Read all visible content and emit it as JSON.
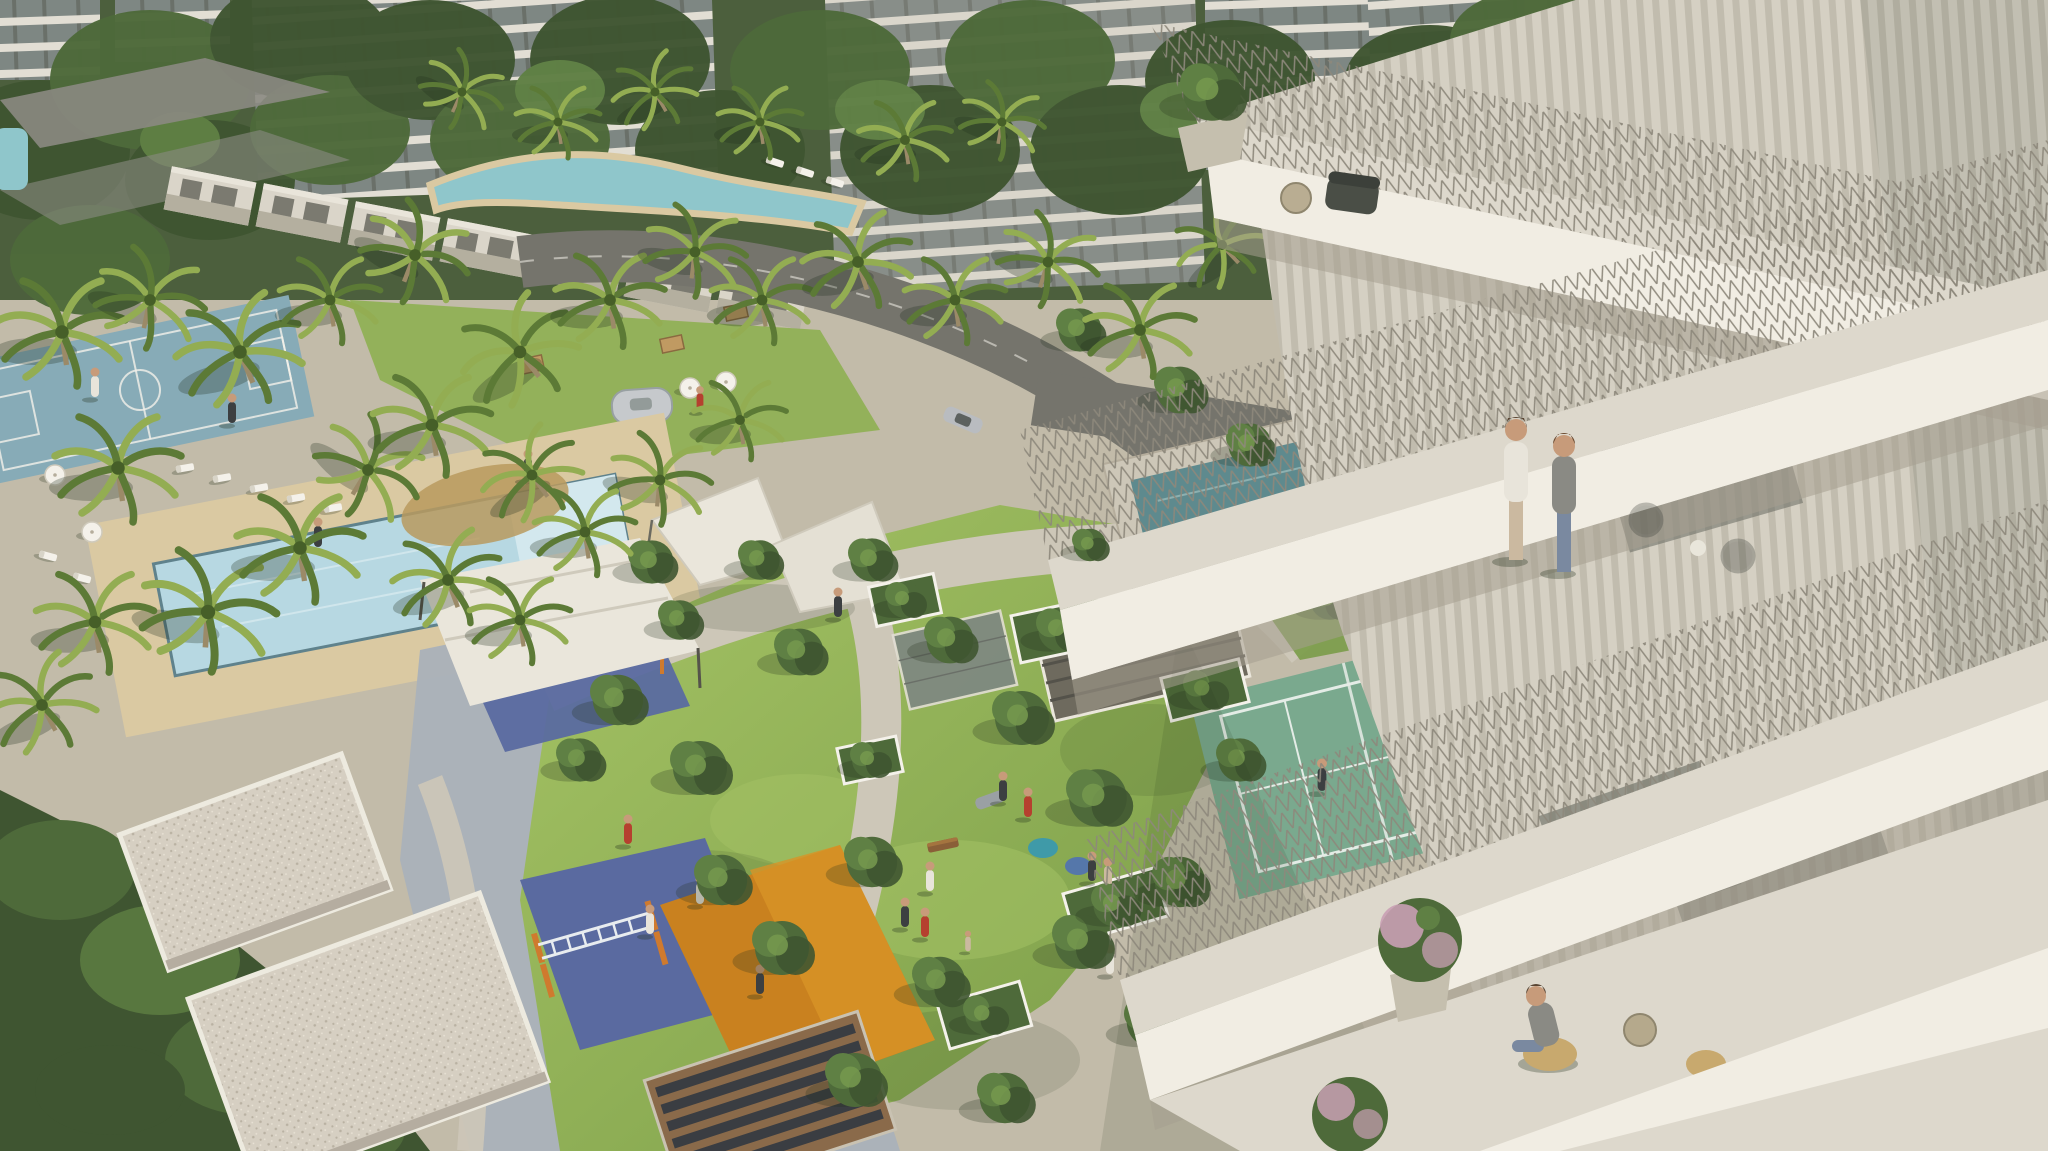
{
  "scene": {
    "type": "aerial-architectural-rendering",
    "elements": [
      "foreground-residential-tower-with-balconies",
      "background-apartment-blocks",
      "townhouse-row",
      "palm-grove",
      "lagoon-pool",
      "lap-swimming-pool",
      "basketball-court",
      "tennis-court",
      "reflecting-pool",
      "central-lawn",
      "shade-sails",
      "fitness-playground",
      "calisthenics-canopy",
      "food-truck-plaza",
      "villa-rooftops",
      "roads-with-cars",
      "balcony-people",
      "park-people"
    ]
  },
  "palette": {
    "ground": "#c2bba9",
    "canopyDark": "#3f5531",
    "canopyMid": "#4e6a3a",
    "canopyLight": "#5f8044",
    "treeHighlight": "#74974e",
    "palmDark": "#5c7a36",
    "palmLight": "#93ad52",
    "trunk": "#9b8a68",
    "lawn": "#8fb054",
    "lawnLight": "#a6c465",
    "lawnShade": "#7a9c48",
    "dryGrass": "#b89a5e",
    "poolWater": "#b7d8e2",
    "poolStep": "#d3e8ee",
    "poolRim": "#5f828c",
    "lagoon": "#8fc6cb",
    "bballCourt": "#87abb7",
    "tennisCourt": "#7aa98e",
    "tennisLine": "#e4ece6",
    "canalWater": "#6fa6a0",
    "enclosureWater": "#5e8a8e",
    "sandDeck": "#dac9a2",
    "pathLight": "#cdc7b8",
    "plazaPavers": "#aab1b9",
    "asphalt": "#75746c",
    "asphaltLight": "#8b8a82",
    "roadMark": "#e8e6dd",
    "buildingWall": "#b8b2a4",
    "buildingBand": "#e2ded4",
    "glass": "#7e8783",
    "glassDark": "#5d6058",
    "villaWall": "#dad5c9",
    "villaShade": "#b4af9f",
    "villaGlass": "#6a6a60",
    "facade": "#d5d0c3",
    "facadeRib": "#c1bcae",
    "facadeShadow": "#a59f90",
    "slabWhite": "#f1ede3",
    "balconyFloor": "#ddd8cc",
    "railing": "#8d887b",
    "gravel": "#d6cfc2",
    "gravelDot": "#b9b1a2",
    "slatRoof": "#6e6a5e",
    "slatLine": "#54524a",
    "pergolaWood": "#8a6a4a",
    "pergolaGap": "#3a3d42",
    "canvasWhite": "#eae6db",
    "canvasShade": "#cfcabc",
    "playBlue": "#5a6aa0",
    "playOrange": "#c9811f",
    "playOrangeSun": "#d89427",
    "equipOrange": "#cf7a2e",
    "equipYellow": "#e2c23a",
    "ladderWhite": "#e8ecef",
    "benchWood": "#8a5f38",
    "wicker": "#c8a96e",
    "flowerPink": "#c9a0b4",
    "personRed": "#b5402f",
    "personWhite": "#e8e4da",
    "personDark": "#3c3f41",
    "personGray": "#8a8a84",
    "personTan": "#cbb9a0",
    "denim": "#7a89a0",
    "skin": "#c79b7a",
    "hair": "#5a4634",
    "beanTeal": "#3f9aa8",
    "beanBlue": "#5577aa",
    "carSilver": "#b9bcc0",
    "carBlue": "#2f6fd0",
    "truckSilver": "#c6c9cc",
    "shadowTint": "#22301c",
    "white": "#f4f1ea"
  }
}
